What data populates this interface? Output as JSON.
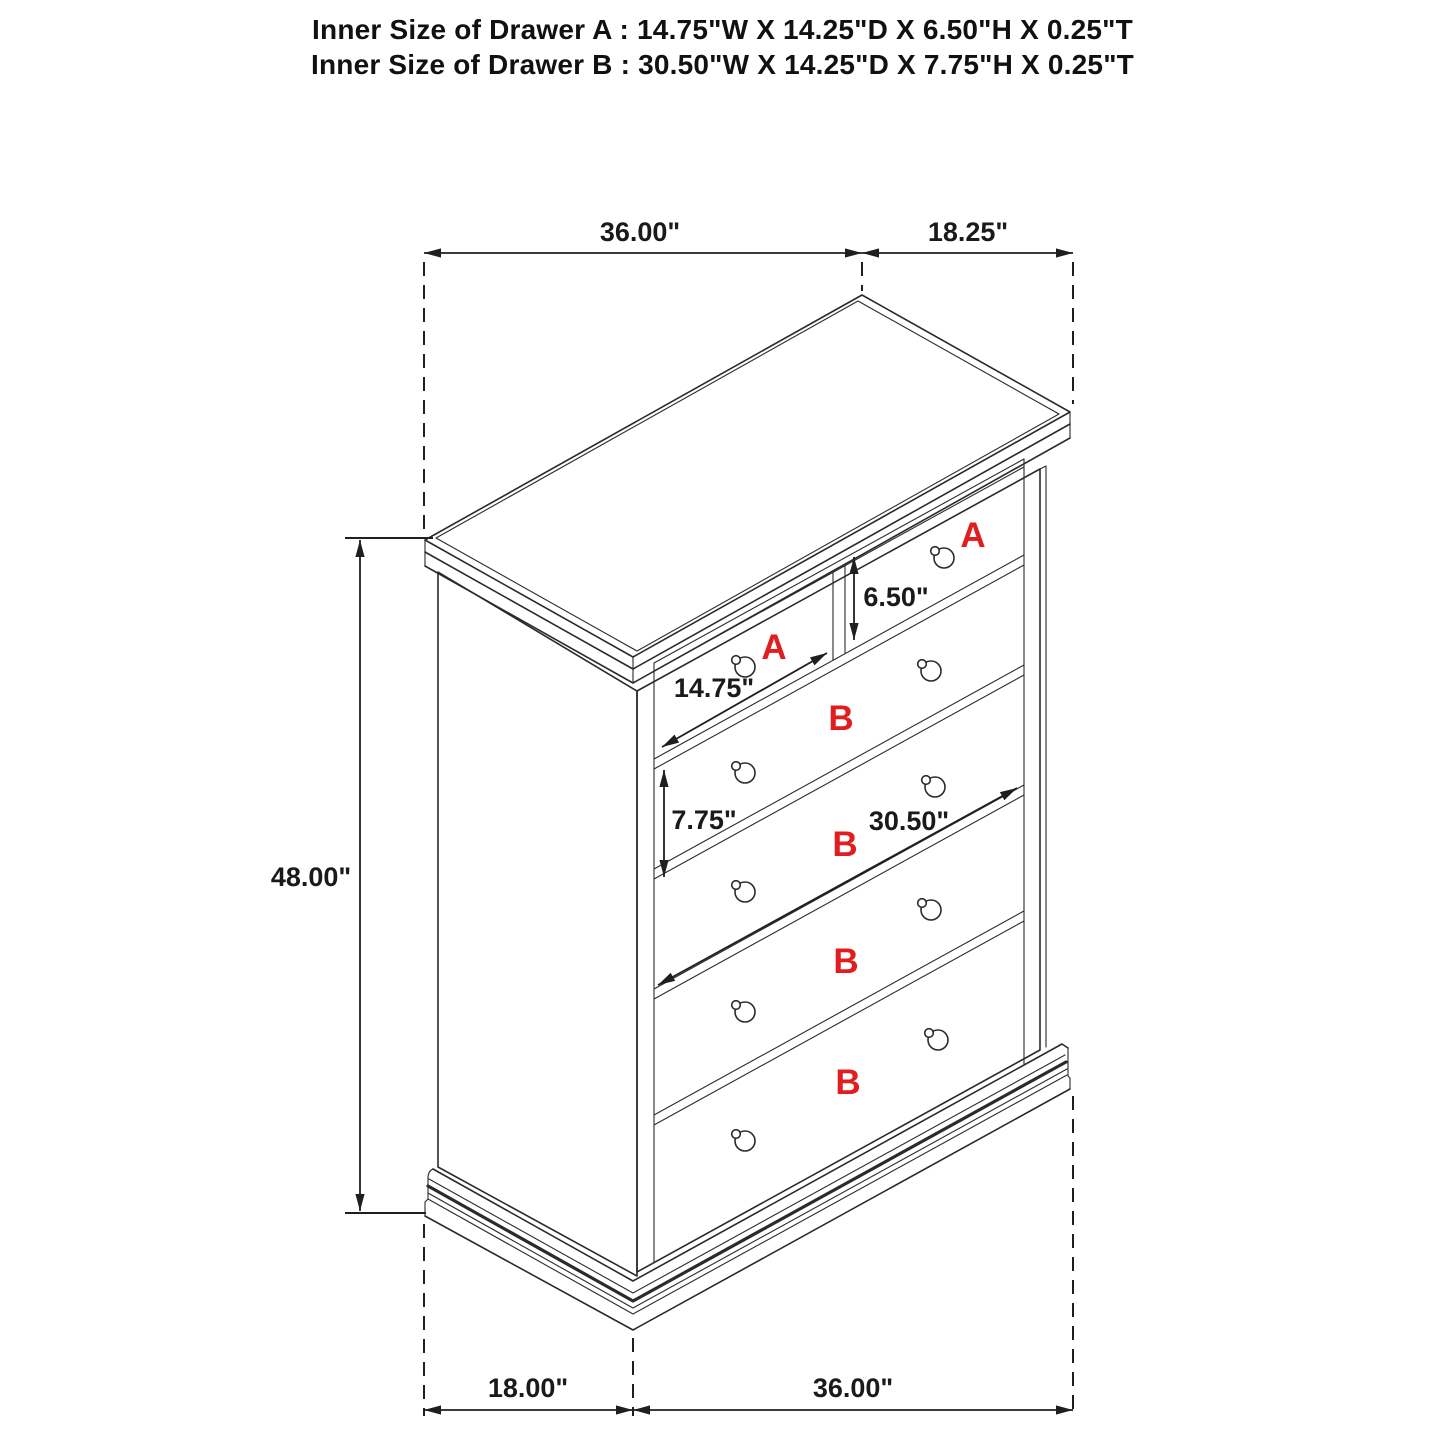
{
  "header": {
    "line1": "Inner Size of Drawer A : 14.75\"W X 14.25\"D X 6.50\"H X 0.25\"T",
    "line2": "Inner Size of Drawer B : 30.50\"W X 14.25\"D X 7.75\"H X 0.25\"T"
  },
  "dimensions": {
    "top_width": "36.00\"",
    "top_depth": "18.25\"",
    "overall_height": "48.00\"",
    "drawer_a_inner_height": "6.50\"",
    "drawer_a_inner_width": "14.75\"",
    "drawer_b_inner_height": "7.75\"",
    "drawer_b_inner_width": "30.50\"",
    "bottom_depth": "18.00\"",
    "bottom_width": "36.00\""
  },
  "drawer_labels": {
    "a_left": "A",
    "a_right": "A",
    "b1": "B",
    "b2": "B",
    "b3": "B",
    "b4": "B"
  },
  "colors": {
    "line": "#2b2b2b",
    "dimension_text": "#1a1a1a",
    "drawer_label_red": "#e11d1f",
    "background": "#ffffff"
  }
}
